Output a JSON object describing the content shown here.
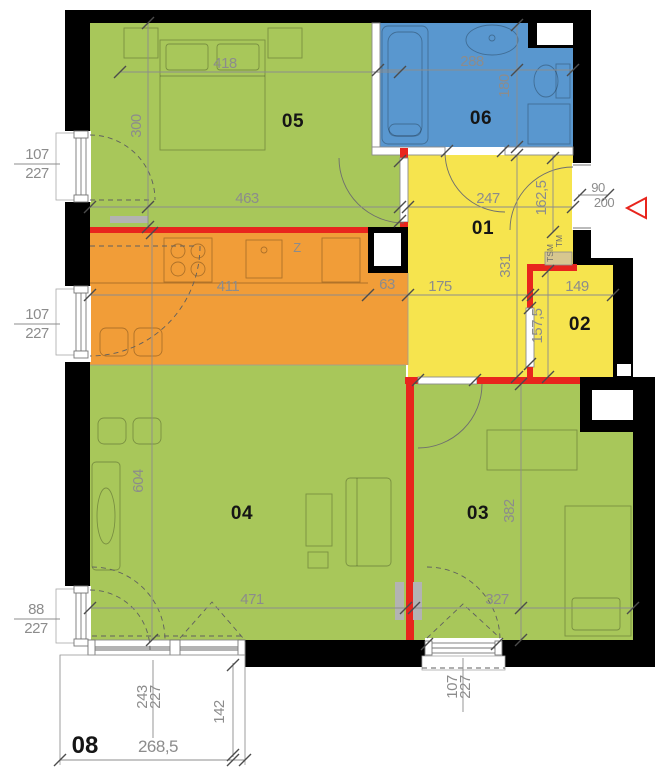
{
  "colors": {
    "green": "#a8c75a",
    "orange": "#f19d38",
    "blue": "#5997cf",
    "yellow": "#f6e44e",
    "red": "#e8251d",
    "wall": "#000000",
    "dim": "#8c8c8c",
    "tan": "#d7c78f",
    "gray": "#b3b3b3"
  },
  "rooms": {
    "r01": "01",
    "r02": "02",
    "r03": "03",
    "r04": "04",
    "r05": "05",
    "r06": "06",
    "r08": "08"
  },
  "dims": {
    "d418": "418",
    "d300": "300",
    "d463": "463",
    "d288": "288",
    "d180": "180",
    "d247": "247",
    "d162_5": "162,5",
    "d331": "331",
    "d411": "411",
    "d63": "63",
    "d175": "175",
    "d149": "149",
    "d157_5": "157,5",
    "d604": "604",
    "d471": "471",
    "d327": "327",
    "d382": "382",
    "d268_5": "268,5",
    "d243": "243",
    "d142": "142",
    "d107": "107",
    "d227": "227",
    "d88": "88",
    "d90": "90",
    "d200": "200"
  },
  "labels": {
    "tm": "TM",
    "tsm": "TSM",
    "z": "Z"
  }
}
